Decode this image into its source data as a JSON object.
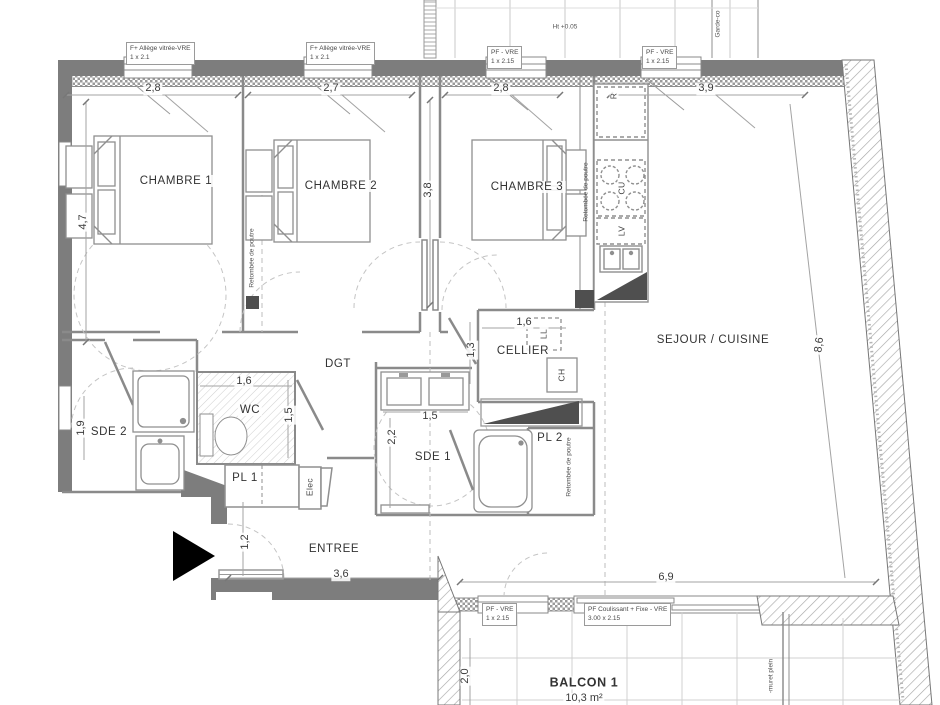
{
  "plan": {
    "rooms": {
      "chambre1": "CHAMBRE 1",
      "chambre2": "CHAMBRE 2",
      "chambre3": "CHAMBRE 3",
      "sejour": "SEJOUR / CUISINE",
      "cellier": "CELLIER",
      "dgt": "DGT",
      "wc": "WC",
      "sde2": "SDE 2",
      "sde1": "SDE 1",
      "pl1": "PL 1",
      "pl2": "PL 2",
      "entree": "ENTREE",
      "balcon1": "BALCON 1",
      "balcon1_area": "10,3 m²"
    },
    "dims": {
      "top_28a": "2,8",
      "top_27": "2,7",
      "top_28b": "2,8",
      "top_39": "3,9",
      "left_47": "4,7",
      "mid_38": "3,8",
      "sde2_19": "1,9",
      "wc_16": "1,6",
      "wc_15": "1,5",
      "cellier_16": "1,6",
      "cellier_13": "1,3",
      "sde1_15": "1,5",
      "sde1_22": "2,2",
      "entree_12": "1,2",
      "entree_36": "3,6",
      "balcon_69": "6,9",
      "balcon_20": "2,0",
      "right_86": "8,6"
    },
    "windows": {
      "w1": {
        "l1": "F+ Allège vitrée-VRE",
        "l2": "1 x 2.1"
      },
      "w2": {
        "l1": "F+ Allège vitrée-VRE",
        "l2": "1 x 2.1"
      },
      "w3": {
        "l1": "PF - VRE",
        "l2": "1 x 2.15"
      },
      "w4": {
        "l1": "PF - VRE",
        "l2": "1 x 2.15"
      },
      "w5": {
        "l1": "PF - VRE",
        "l2": "1 x 2.15"
      },
      "w6": {
        "l1": "PF Coulissant + Fixe - VRE",
        "l2": "3.00 x 2.15"
      }
    },
    "appliances": {
      "fridge": "R",
      "cooktop": "CU",
      "dishwasher": "LV",
      "washer": "LL",
      "boiler": "CH",
      "elec": "Elec"
    },
    "notes": {
      "beam1": "Retombée de poutre",
      "beam2": "Retombée de poutre",
      "beam3": "Retombée de poutre",
      "height": "Ht +0.05",
      "guardrail": "Garde-co",
      "muret": "-muret plein"
    }
  }
}
